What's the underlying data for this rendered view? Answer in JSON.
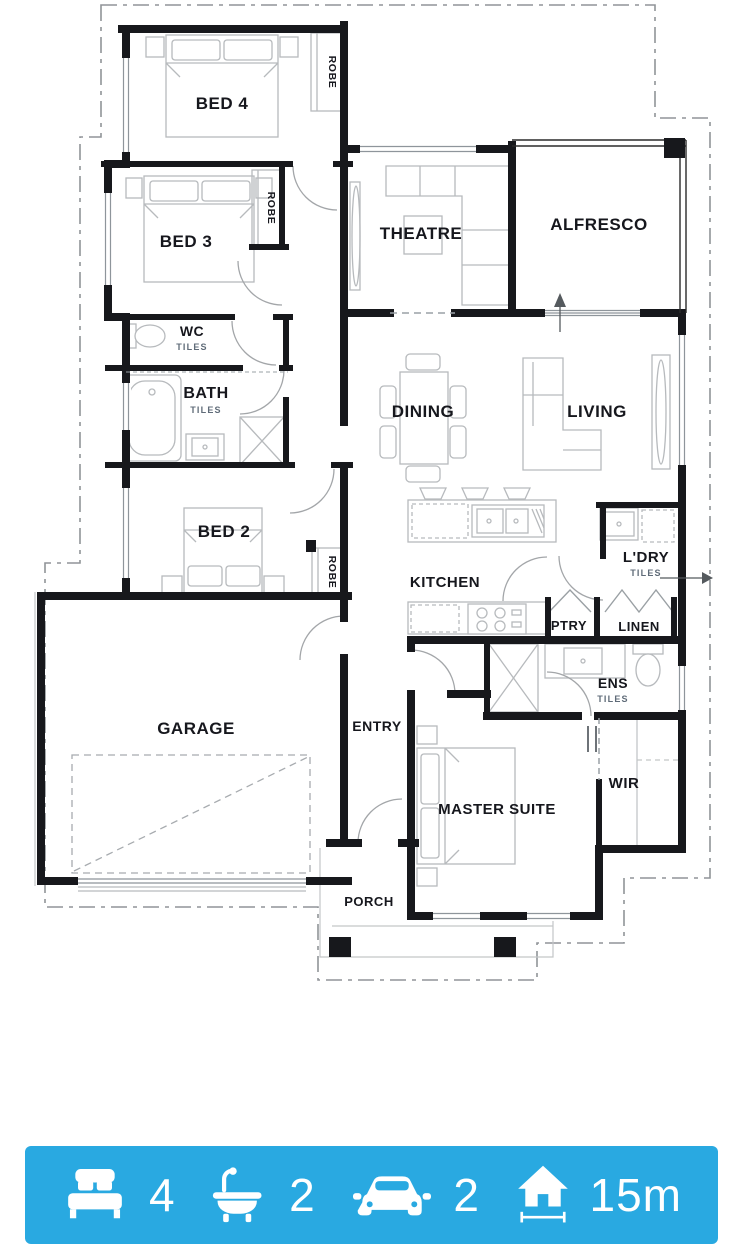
{
  "plan": {
    "rooms": {
      "bed4": "BED 4",
      "bed3": "BED 3",
      "bed2": "BED 2",
      "wc": "WC",
      "bath": "BATH",
      "garage": "GARAGE",
      "theatre": "THEATRE",
      "alfresco": "ALFRESCO",
      "dining": "DINING",
      "living": "LIVING",
      "kitchen": "KITCHEN",
      "ldry": "L'DRY",
      "ptry": "PTRY",
      "linen": "LINEN",
      "ens": "ENS",
      "wir": "WIR",
      "master": "MASTER SUITE",
      "entry": "ENTRY",
      "porch": "PORCH"
    },
    "sub_labels": {
      "tiles": "TILES",
      "robe": "ROBE"
    }
  },
  "stats": {
    "bedrooms": {
      "icon": "bed-icon",
      "value": "4"
    },
    "bathrooms": {
      "icon": "bath-icon",
      "value": "2"
    },
    "cars": {
      "icon": "car-icon",
      "value": "2"
    },
    "frontage": {
      "icon": "house-frontage-icon",
      "value": "15m"
    }
  },
  "colors": {
    "bar": "#29A9E1",
    "wall": "#17181C",
    "label": "#16171D",
    "tiles_text": "#5F6B78"
  }
}
